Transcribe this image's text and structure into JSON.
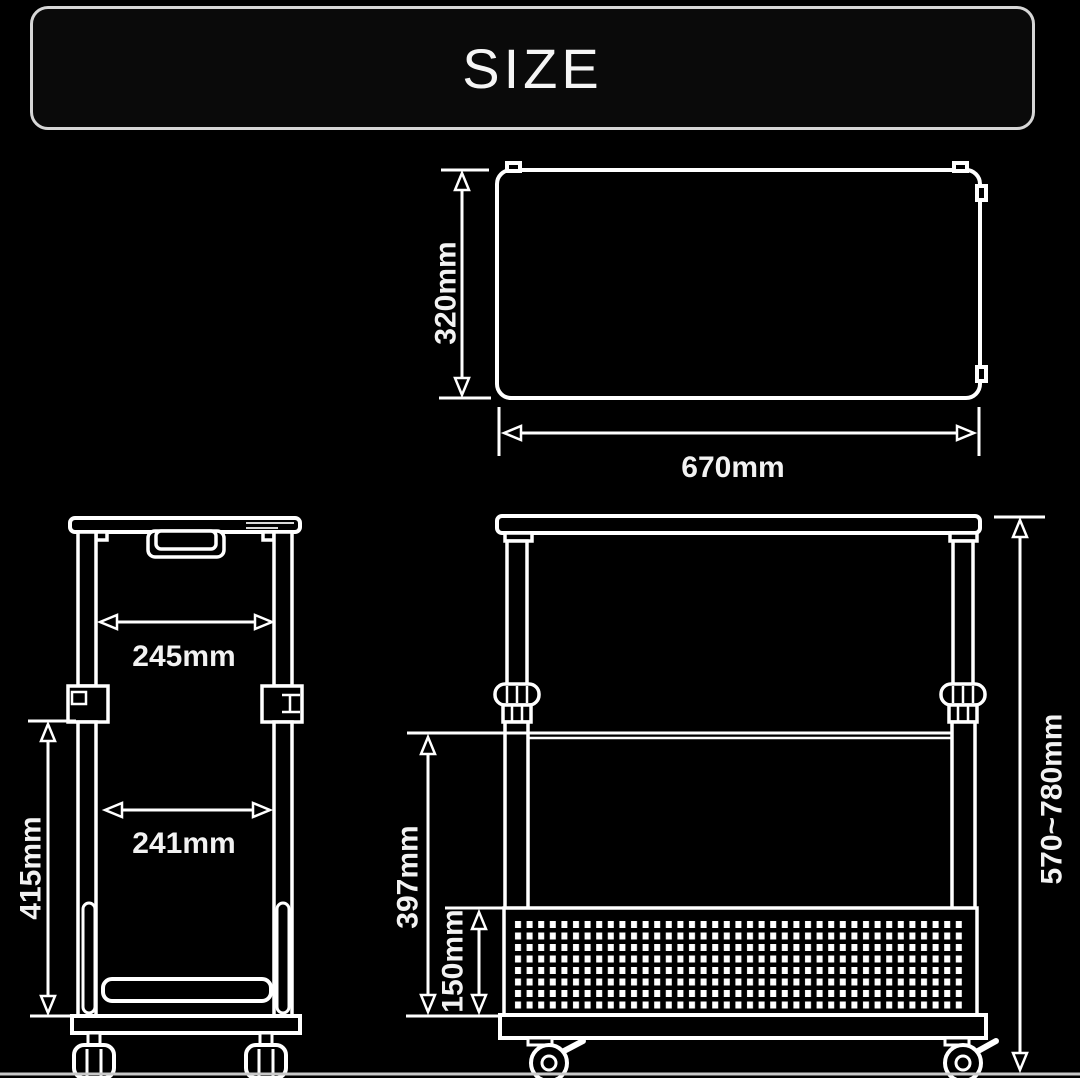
{
  "title": "SIZE",
  "colors": {
    "background": "#000000",
    "line": "#ffffff",
    "title_border": "#d6d6d6",
    "text": "#f2f2f2"
  },
  "views": {
    "top_view": {
      "description": "tabletop-top-view",
      "dimensions": {
        "depth": "320mm",
        "width": "670mm"
      }
    },
    "side_view": {
      "description": "cart-side-view",
      "dimensions": {
        "upper_inner_width": "245mm",
        "lower_inner_width": "241mm",
        "lower_frame_height": "415mm"
      }
    },
    "front_view": {
      "description": "cart-front-view",
      "dimensions": {
        "shelf_to_base_height": "397mm",
        "basket_height": "150mm",
        "overall_height_range": "570~780mm"
      }
    }
  }
}
